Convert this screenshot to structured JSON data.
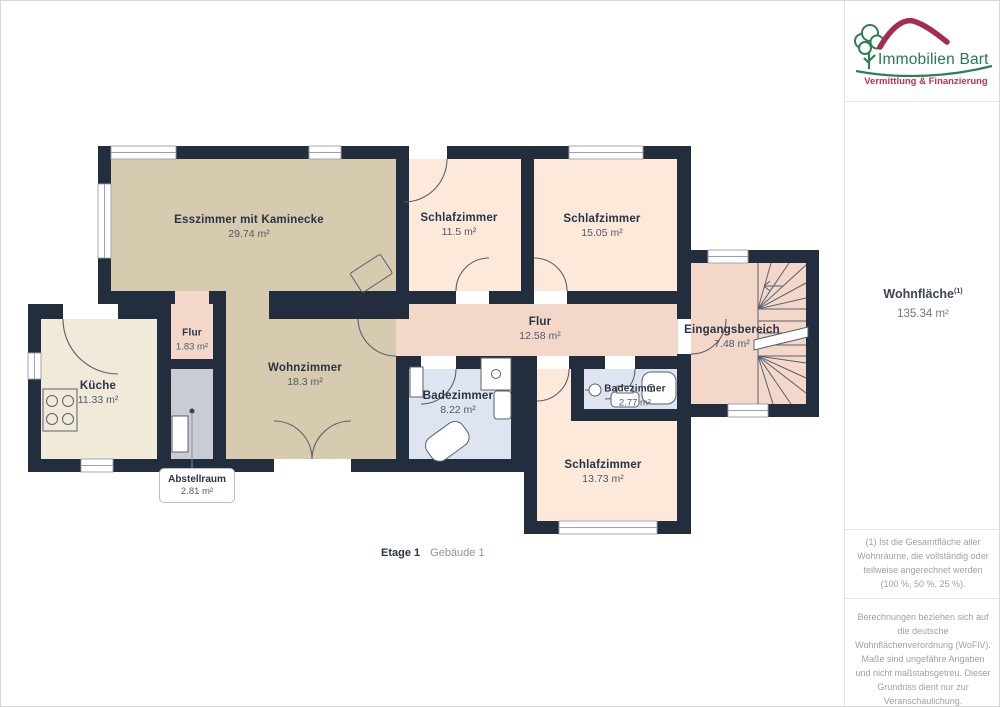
{
  "logo": {
    "title": "Immobilien Bart",
    "subtitle": "Vermittlung & Finanzierung"
  },
  "summary": {
    "label": "Wohnfläche",
    "footnote_ref": "(1)",
    "value": "135.34 m²"
  },
  "rooms": [
    {
      "id": "esszimmer",
      "name": "Esszimmer mit Kaminecke",
      "area": "29.74 m²"
    },
    {
      "id": "schlafzimmer-1",
      "name": "Schlafzimmer",
      "area": "11.5 m²"
    },
    {
      "id": "schlafzimmer-2",
      "name": "Schlafzimmer",
      "area": "15.05 m²"
    },
    {
      "id": "eingangsbereich",
      "name": "Eingangsbereich",
      "area": "7.48 m²"
    },
    {
      "id": "flur",
      "name": "Flur",
      "area": "12.58 m²"
    },
    {
      "id": "flur-klein",
      "name": "Flur",
      "area": "1.83 m²"
    },
    {
      "id": "kueche",
      "name": "Küche",
      "area": "11.33 m²"
    },
    {
      "id": "wohnzimmer",
      "name": "Wohnzimmer",
      "area": "18.3 m²"
    },
    {
      "id": "badezimmer-1",
      "name": "Badezimmer",
      "area": "8.22 m²"
    },
    {
      "id": "badezimmer-2",
      "name": "Badezimmer",
      "area": "2.77 m²"
    },
    {
      "id": "schlafzimmer-3",
      "name": "Schlafzimmer",
      "area": "13.73 m²"
    },
    {
      "id": "abstellraum",
      "name": "Abstellraum",
      "area": "2.81 m²"
    }
  ],
  "caption": {
    "floor": "Etage 1",
    "building": "Gebäude 1"
  },
  "footnotes": {
    "note1": "(1) Ist die Gesamtfläche aller Wohnräume, die vollständig oder teilweise angerechnet werden (100 %, 50 %, 25 %).",
    "note2": "Berechnungen beziehen sich auf die deutsche Wohnflächenverordnung (WoFlV). Maße sind ungefähre Angaben und nicht maßstabsgetreu. Dieser Grundriss dient nur zur Veranschaulichung."
  },
  "branding": {
    "name": "GIRAFFE",
    "suffix": "360"
  },
  "colors": {
    "wall": "#222e3e",
    "room-tan": "#d6cbae",
    "room-cream": "#f1ead8",
    "room-peach": "#fce9d9",
    "room-salmon": "#f3d8ca",
    "room-bath": "#dfe5f0",
    "room-gray": "#c9ccd2",
    "label-dark": "#2a3346",
    "label-muted": "#4d5a6b",
    "logo-green": "#237a50",
    "logo-red": "#b62d55"
  }
}
